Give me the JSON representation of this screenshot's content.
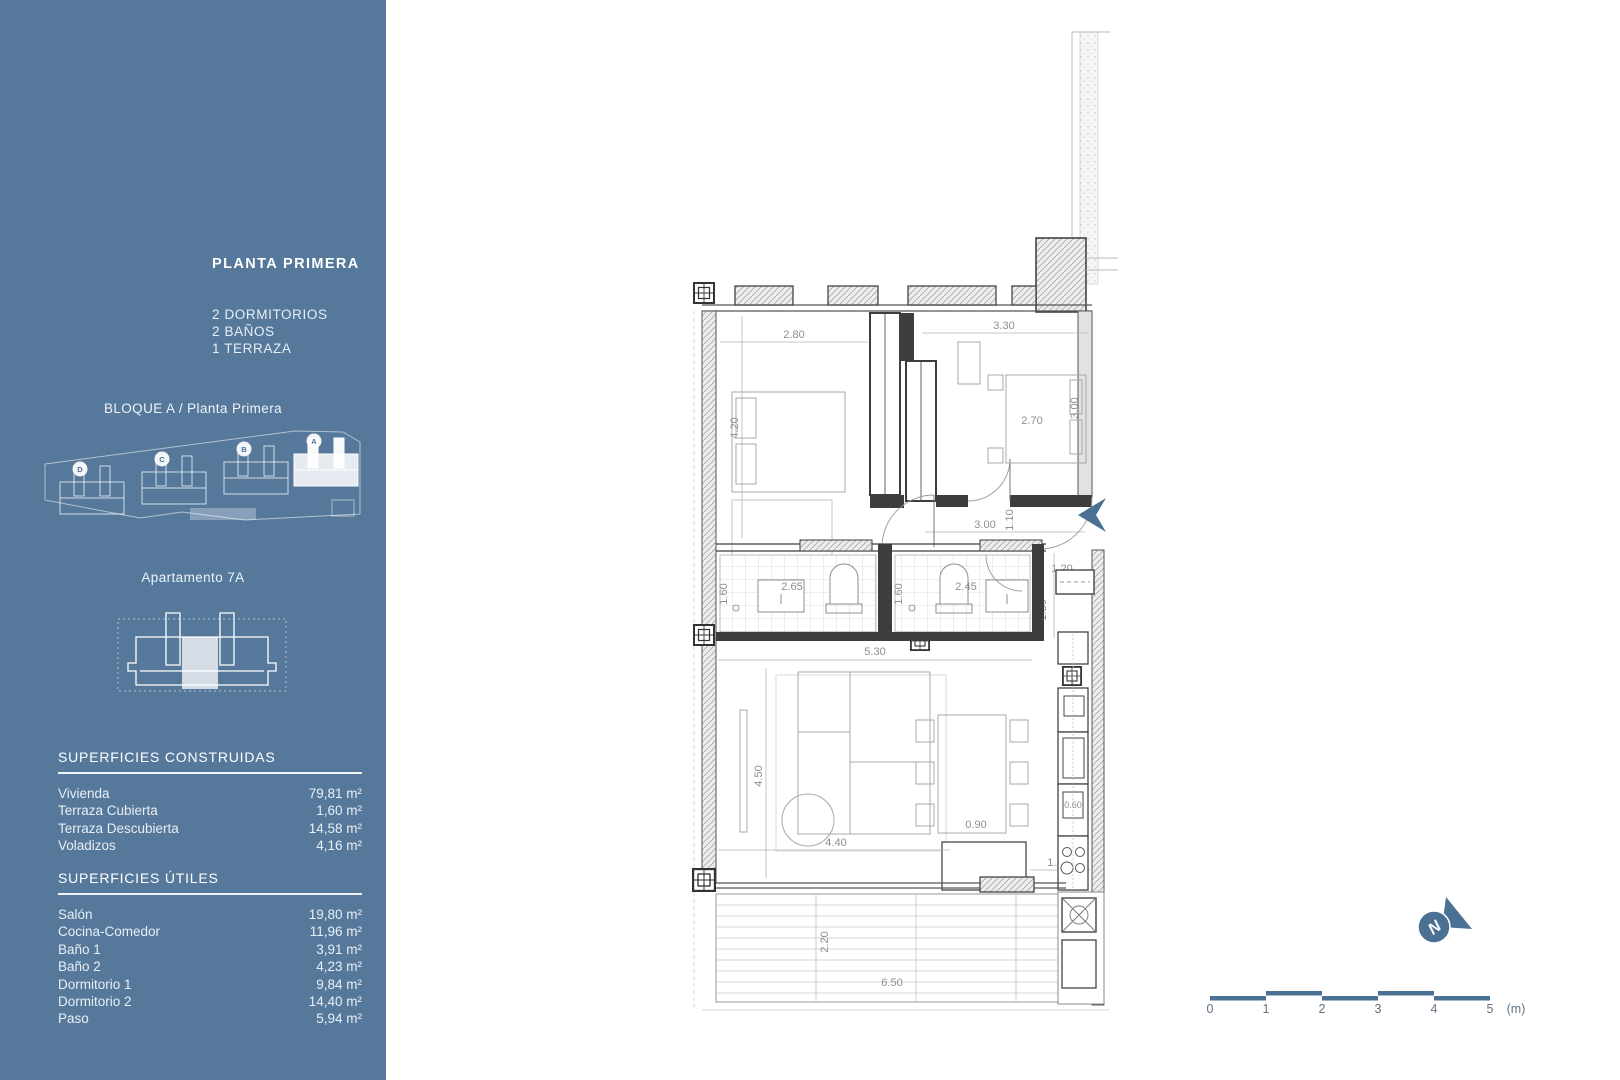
{
  "colors": {
    "sidebar_background": "#55789b",
    "accent_blue": "#4a7194",
    "wall_dark": "#3d3d3d"
  },
  "sidebar": {
    "title": "PLANTA PRIMERA",
    "features": [
      "2 DORMITORIOS",
      "2 BAÑOS",
      "1 TERRAZA"
    ],
    "block_label": "BLOQUE A / Planta Primera",
    "site_blocks": [
      "D",
      "C",
      "B",
      "A"
    ],
    "apartment_label": "Apartamento 7A",
    "surfaces_built": {
      "heading": "SUPERFICIES CONSTRUIDAS",
      "rows": [
        {
          "label": "Vivienda",
          "value": "79,81 m²"
        },
        {
          "label": "Terraza Cubierta",
          "value": "1,60 m²"
        },
        {
          "label": "Terraza Descubierta",
          "value": "14,58 m²"
        },
        {
          "label": "Voladizos",
          "value": "4,16 m²"
        }
      ]
    },
    "surfaces_useful": {
      "heading": "SUPERFICIES ÚTILES",
      "rows": [
        {
          "label": "Salón",
          "value": "19,80 m²"
        },
        {
          "label": "Cocina-Comedor",
          "value": "11,96 m²"
        },
        {
          "label": "Baño 1",
          "value": "3,91 m²"
        },
        {
          "label": "Baño 2",
          "value": "4,23 m²"
        },
        {
          "label": "Dormitorio 1",
          "value": "9,84 m²"
        },
        {
          "label": "Dormitorio 2",
          "value": "14,40 m²"
        },
        {
          "label": "Paso",
          "value": "5,94 m²"
        }
      ]
    }
  },
  "plan": {
    "dims": {
      "bed1_w": "2.80",
      "bed1_h": "4.20",
      "bed2_w": "3.30",
      "bed2_inner": "2.70",
      "bed2_h": "3.00",
      "hall_w": "3.00",
      "hall_h": "1.10",
      "pass_w": "1.20",
      "pass_h": "1.80",
      "bath1_h": "1.60",
      "bath1_w": "2.65",
      "bath2_h": "1.60",
      "bath2_w": "2.45",
      "living_w": "5.30",
      "living_h": "4.50",
      "sofa_w": "4.40",
      "island_w": "0.90",
      "kitchen_w": "1.20",
      "counter_d": "0.60",
      "terrace_h": "2.20",
      "terrace_w": "6.50"
    },
    "compass_letter": "N",
    "scale": {
      "labels": [
        "0",
        "1",
        "2",
        "3",
        "4",
        "5"
      ],
      "unit": "(m)"
    }
  }
}
